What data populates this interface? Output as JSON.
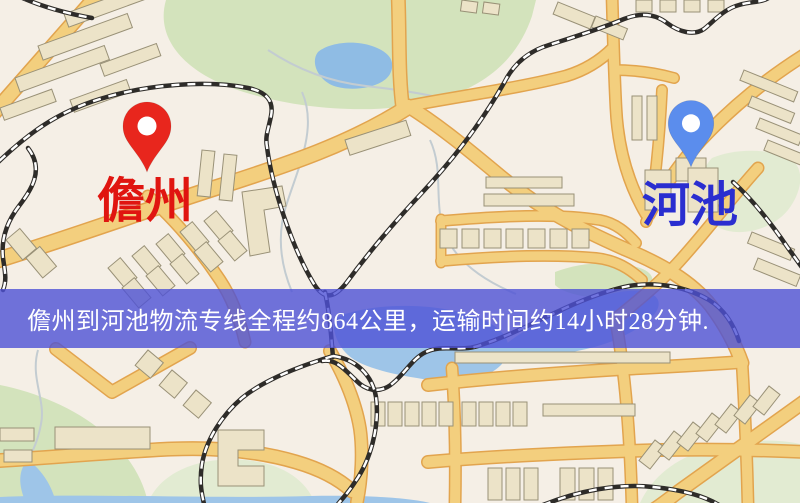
{
  "banner": {
    "text": "儋州到河池物流专线全程约864公里，运输时间约14小时28分钟."
  },
  "origin": {
    "label": "儋州",
    "pin": "red-location-pin"
  },
  "destination": {
    "label": "河池",
    "pin": "blue-location-pin"
  },
  "colors": {
    "c-land": "#f5efe6",
    "c-green": "#d3e3bc",
    "c-green-pale": "#e2ebd2",
    "c-water": "#9ec5e8",
    "c-water-deep": "#8fbce4",
    "c-road": "#f3cf7e",
    "c-road-edge": "#e2a44e",
    "c-building": "#ece3c8",
    "c-building-edge": "#999177",
    "c-rail": "#2e2c29",
    "c-origin": "#e8261d",
    "c-origin-label": "#e01510",
    "c-dest": "#5b8ded",
    "c-dest-label": "#2a2ed0",
    "c-banner-bg": "rgba(77,81,214,0.8)",
    "c-banner-text": "#ffffff"
  }
}
